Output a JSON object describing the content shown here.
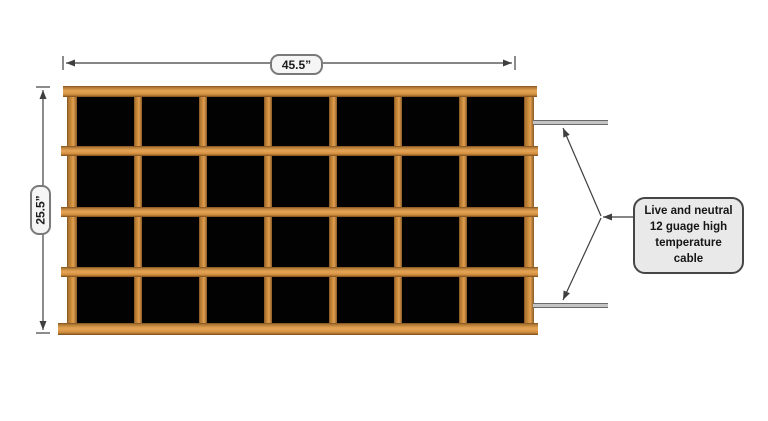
{
  "dimensions": {
    "width_label": "45.5”",
    "height_label": "25.5”"
  },
  "note": {
    "lines": [
      "Live and neutral",
      "12 guage high",
      "temperature cable"
    ]
  },
  "grid": {
    "rows": 4,
    "columns": 7
  },
  "colors": {
    "wood_light": "#e2a152",
    "wood_mid": "#cf8d3c",
    "cell_black": "#020202",
    "line": "#3f3f3f",
    "cable_gray": "#c4c4c4",
    "note_bg": "#e9e9e9"
  }
}
